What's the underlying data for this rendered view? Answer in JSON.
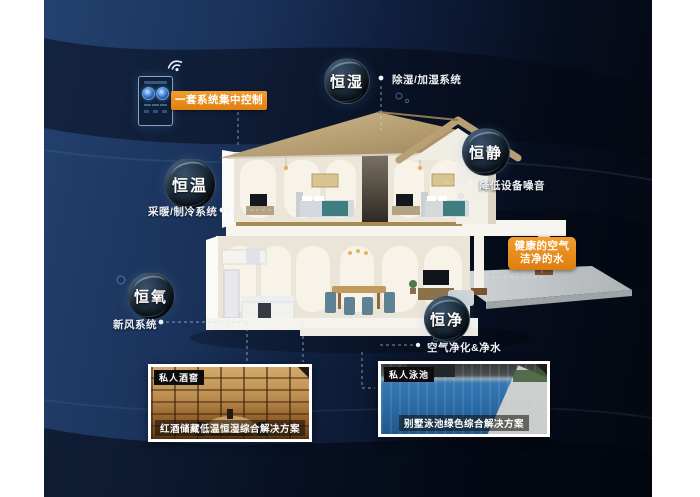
{
  "scene": {
    "control_label": "一套系统集中控制",
    "benefit_box": {
      "line1": "健康的空气",
      "line2": "洁净的水"
    }
  },
  "bubbles": [
    {
      "label": "恒湿",
      "annotation": "除湿/加湿系统"
    },
    {
      "label": "恒静",
      "annotation": "降低设备噪音"
    },
    {
      "label": "恒温",
      "annotation": "采暖/制冷系统"
    },
    {
      "label": "恒氧",
      "annotation": "新风系统"
    },
    {
      "label": "恒净",
      "annotation": "空气净化&净水"
    }
  ],
  "photos": [
    {
      "tag": "私人酒窖",
      "caption": "红酒储藏低温恒湿综合解决方案"
    },
    {
      "tag": "私人泳池",
      "caption": "别墅泳池绿色综合解决方案"
    }
  ],
  "icons": [
    "wifi-icon"
  ],
  "colors": {
    "accent_orange": "#e78a1a",
    "background_navy": "#16294d",
    "roof_tan": "#b89d6f"
  }
}
